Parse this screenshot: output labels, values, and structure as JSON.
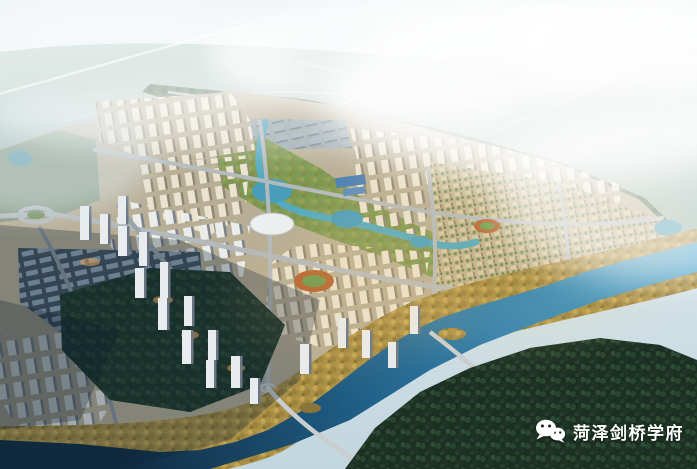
{
  "scene": {
    "type": "aerial-city-master-plan-rendering",
    "regions": [
      "hazy-sky",
      "misty-green-hills",
      "distant-highways",
      "tree-belt",
      "high-rise-district",
      "central-park-canal",
      "low-rise-district",
      "industrial-warehouse-zone",
      "stadiums",
      "riverside-autumn-trees",
      "winding-river",
      "dark-forest",
      "cloud-shadow"
    ],
    "watermark": {
      "icon": "wechat-icon",
      "text": "菏泽剑桥学府",
      "color": "#ffffff"
    }
  },
  "palette": {
    "sky_top": "#eef4f6",
    "sky_low": "#c2d6de",
    "fog": "#ffffff",
    "hills": "#8fab9e",
    "tree_belt": "#4a6a4e",
    "city_base": "#b8ae95",
    "building_cream": "#e9e3d0",
    "building_white": "#eef0ee",
    "building_shadow_side": "#8e8672",
    "park_green": "#7a9b55",
    "canal_teal": "#55aabf",
    "river_bright": "#46a0cc",
    "river_dark": "#112c42",
    "autumn_gold": "#b2954a",
    "forest_dark": "#1b2f22",
    "road_light": "#b3babe",
    "track_orange": "#b5652f",
    "landmark_blue_roof": "#4a7fb5"
  }
}
